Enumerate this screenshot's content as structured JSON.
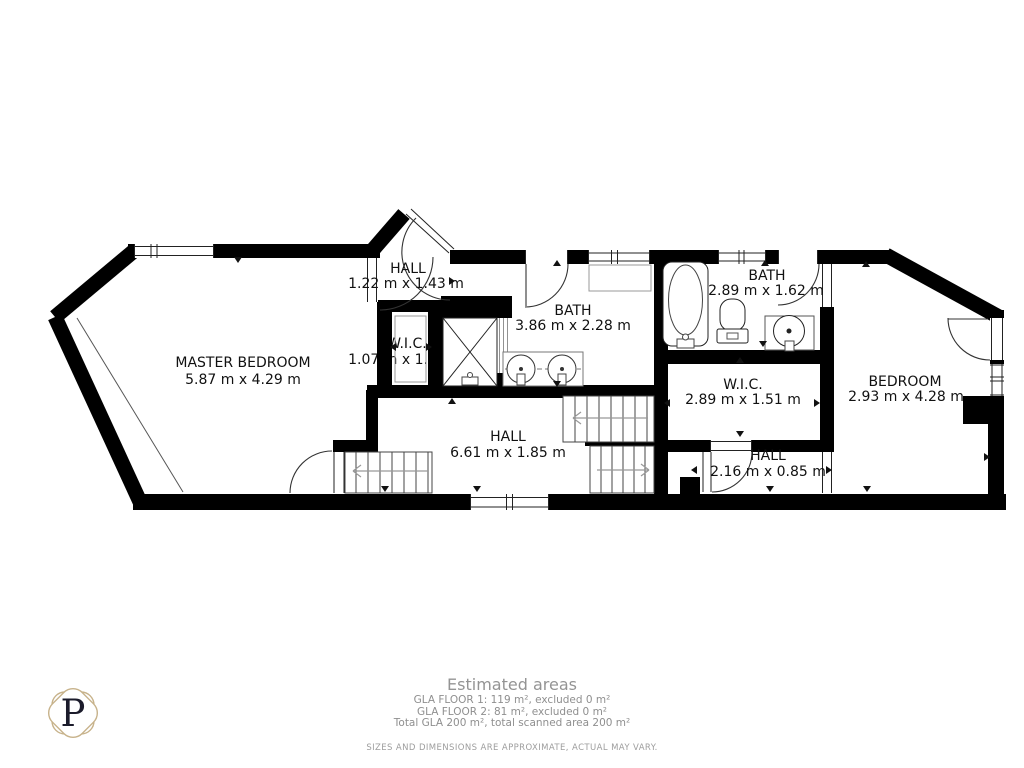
{
  "rooms": {
    "master_bedroom": {
      "name": "MASTER BEDROOM",
      "dims": "5.87 m x 4.29 m"
    },
    "hall_entry": {
      "name": "HALL",
      "dims": "1.22 m x 1.43 m"
    },
    "wic_small": {
      "name": "W.I.C.",
      "dims": "1.07 m x 1.33 m"
    },
    "bath_main": {
      "name": "BATH",
      "dims": "3.86 m x 2.28 m"
    },
    "bath_second": {
      "name": "BATH",
      "dims": "2.89 m x 1.62 m"
    },
    "wic_large": {
      "name": "W.I.C.",
      "dims": "2.89 m x 1.51 m"
    },
    "bedroom": {
      "name": "BEDROOM",
      "dims": "2.93 m x 4.28 m"
    },
    "hall_main": {
      "name": "HALL",
      "dims": "6.61 m x 1.85 m"
    },
    "hall_small": {
      "name": "HALL",
      "dims": "2.16 m x 0.85 m"
    }
  },
  "footer": {
    "title": "Estimated areas",
    "line1": "GLA FLOOR 1: 119 m², excluded 0 m²",
    "line2": "GLA FLOOR 2: 81 m², excluded 0 m²",
    "line3": "Total GLA 200 m², total scanned area 200 m²",
    "disclaimer": "SIZES AND DIMENSIONS ARE APPROXIMATE, ACTUAL MAY VARY."
  },
  "logo": {
    "letter": "P",
    "border_color": "#C7B28A"
  },
  "fixtures": [
    "bathtub",
    "toilet",
    "sink",
    "double-vanity",
    "shower",
    "stairs"
  ],
  "colors": {
    "wall": "#000000",
    "fixture_stroke": "#444444",
    "label": "#111111",
    "footer_text": "#949494"
  }
}
